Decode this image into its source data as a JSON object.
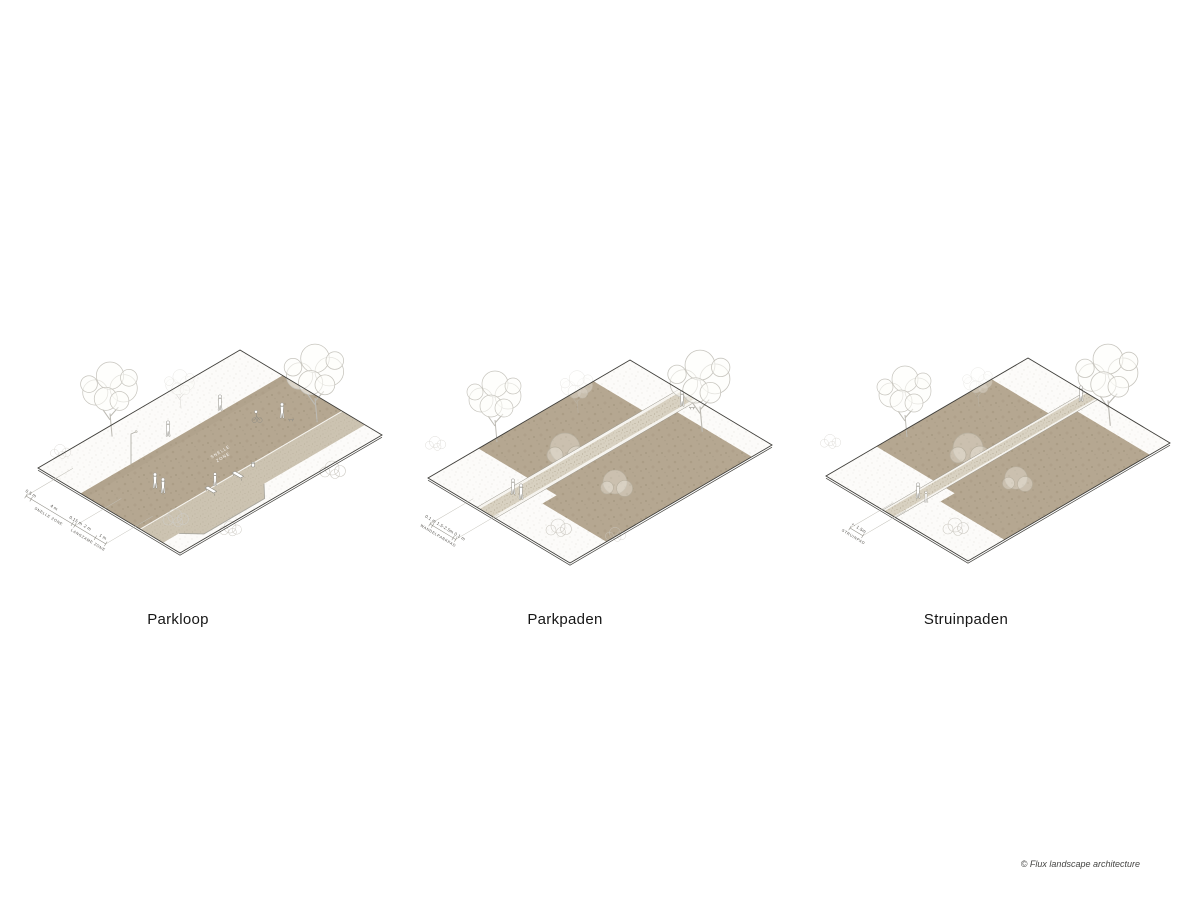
{
  "page": {
    "background": "#ffffff",
    "copyright": "© Flux landscape architecture"
  },
  "colors": {
    "path_brown": "#b5a791",
    "slow_zone_gravel": "#ccc3b1",
    "walk_path_gravel": "#d8d1c1",
    "ground_plane": "#fcfbf9",
    "plane_outline": "#3f3e3a",
    "tree_lineart": "#c7c5be"
  },
  "diagrams": [
    {
      "id": "parkloop",
      "title": "Parkloop",
      "path_text_lines": [
        "SNELLE",
        "ZONE"
      ],
      "dimensions": [
        {
          "value": "0.5 m"
        },
        {
          "value": "4 m",
          "zone": "SNELLE ZONE"
        },
        {
          "value": "0.15 m"
        },
        {
          "value": "2 m"
        },
        {
          "value": "1 m",
          "zone": "LANGZAME ZONE"
        }
      ]
    },
    {
      "id": "parkpaden",
      "title": "Parkpaden",
      "dimensions": [
        {
          "value": "0.1 m"
        },
        {
          "value": "1.5-2.5m",
          "zone": "WANDELPARKPAD"
        },
        {
          "value": "0.1 m"
        }
      ]
    },
    {
      "id": "struinpaden",
      "title": "Struinpaden",
      "dimensions": [
        {
          "value": "+- 1.5m",
          "zone": "STRUINPAD"
        }
      ]
    }
  ]
}
